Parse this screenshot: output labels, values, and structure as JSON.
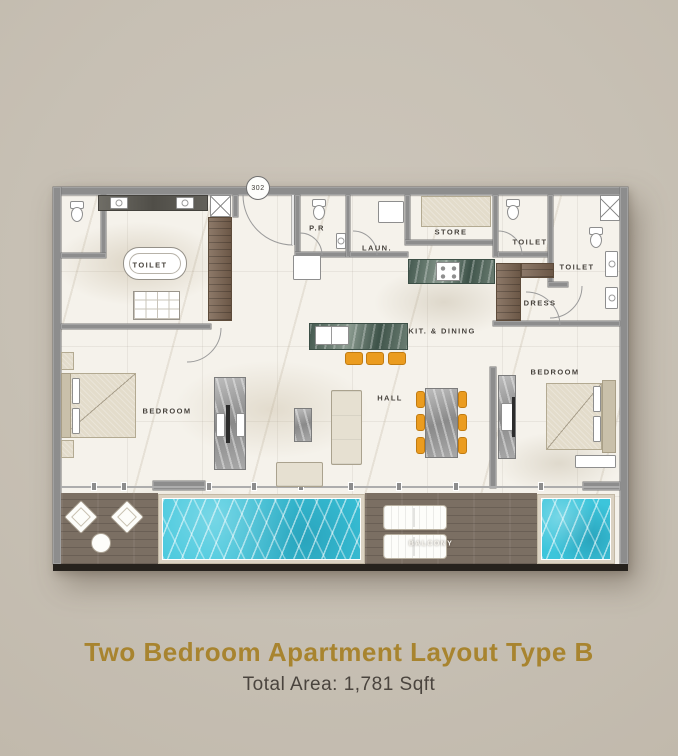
{
  "plan": {
    "unit_badge": "302",
    "rooms": {
      "toilet_left": "TOILET",
      "powder": "P.R",
      "laundry": "LAUN.",
      "store": "STORE",
      "toilet_mid": "TOILET",
      "toilet_right": "TOILET",
      "dress": "DRESS",
      "kitchen_dining": "KIT. & DINING",
      "bedroom_left": "BEDROOM",
      "hall": "HALL",
      "bedroom_right": "BEDROOM",
      "balcony": "BALCONY"
    }
  },
  "footer": {
    "title": "Two Bedroom Apartment Layout Type B",
    "area": "Total Area: 1,781 Sqft"
  },
  "colors": {
    "background": "#c7c0b4",
    "wall": "#8d8d8d",
    "title_gold": "#a8842f",
    "subtitle_text": "#4a443e",
    "pool_water": "#3cc5db",
    "wood": "#7a6350",
    "deck_wood": "#7b6f63",
    "stool_orange": "#eb9c1f",
    "plan_floor": "#f5f2eb"
  }
}
